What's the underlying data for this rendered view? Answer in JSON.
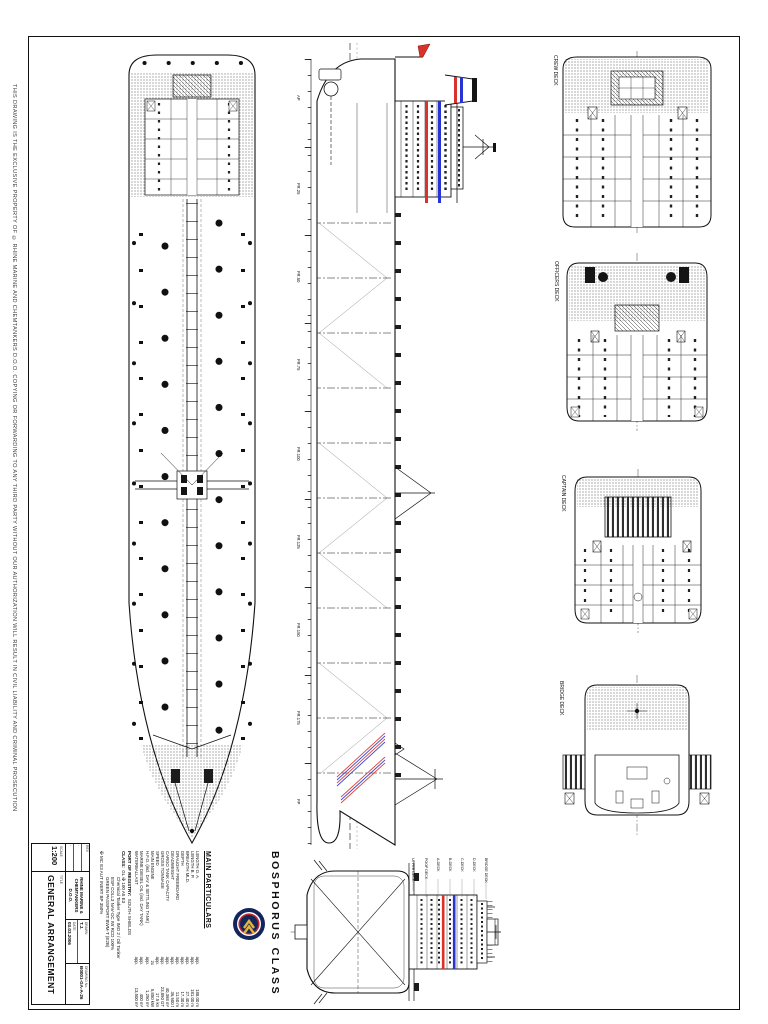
{
  "sheet": {
    "margin_notice": "THIS DRAWING IS THE EXCLUSIVE PROPERTY OF © RHINE MARINE AND CHEMTANKERS D.O.O.  COPYING OR FORWARDING TO ANY THIRD PARTY WITHOUT OUR AUTHORIZATION WILL RESULT IN CIVIL LIABILITY AND CRIMINAL PROSECUTION",
    "watermark": "CHEMTANKER.ORG"
  },
  "vessel": {
    "class_name": "BOSPHORUS CLASS",
    "particulars_heading": "MAIN PARTICULARS",
    "particulars": [
      {
        "label": "LENGTH O. A.",
        "approx": "app.",
        "value": "188.00 m"
      },
      {
        "label": "LENGTH B. P.",
        "approx": "app.",
        "value": "181.00 m"
      },
      {
        "label": "BREADTH MLD.",
        "approx": "app.",
        "value": "27.40 m"
      },
      {
        "label": "DEPTH",
        "approx": "app.",
        "value": "17.30 m"
      },
      {
        "label": "DRAUGHT FREEBOARD",
        "approx": "app.",
        "value": "11.50 m"
      },
      {
        "label": "DEADWEIGHT",
        "approx": "app.",
        "value": "36,500 t"
      },
      {
        "label": "CARGO TANK CAPACITY",
        "approx": "app.",
        "value": "40,368 m³"
      },
      {
        "label": "GROSS TONNAGE",
        "approx": "app.",
        "value": "23,850 GT"
      },
      {
        "label": "SPEED",
        "approx": "app.",
        "value": "17.5 kn"
      },
      {
        "label": "MAIN ENGINE",
        "approx": "2x",
        "value": "5,850 kW"
      },
      {
        "label": "H.F.O. (incl. DAY & SETTLING TANK)",
        "approx": "app.",
        "value": "1,250 m³"
      },
      {
        "label": "MARINE DIESEL OIL (incl. DAY TANK)",
        "approx": "app.",
        "value": "400 m³"
      },
      {
        "label": "WATERBALLAST",
        "approx": "app.",
        "value": "13,500 m³"
      }
    ],
    "registry_label": "PORT OF REGISTRY:",
    "registry_value": "SOUTH SHIELDS",
    "class_label": "CLASS:",
    "class_value": "GL ✠ 100 A5 E3",
    "class_notations": [
      "Chemical Tanker Type IMO 2 / Oil Tanker",
      "ESP COLL3 NAV-OC IW RCD 100%",
      "GREEN PASSPORT BWM-T (E2B)",
      "✠ MC E3 AUT INERT BP 350%"
    ]
  },
  "views": {
    "deck_plans": [
      {
        "label": "CREW DECK"
      },
      {
        "label": "OFFICERS DECK"
      },
      {
        "label": "CAPTAIN DECK"
      },
      {
        "label": "BRIDGE DECK"
      }
    ],
    "aft_deck_labels": [
      "BRIDGE DECK",
      "D-DECK",
      "C-DECK",
      "B-DECK",
      "A-DECK",
      "POOP DECK",
      "UPPER DECK"
    ],
    "frame_marks": [
      "AP",
      "FR.25",
      "FR.50",
      "FR.75",
      "FR.100",
      "FR.125",
      "FR.150",
      "FR.175",
      "FP"
    ]
  },
  "title_block": {
    "scale_label": "SCALE",
    "scale": "1:200",
    "title_label": "TITLE",
    "title": "GENERAL ARRANGEMENT",
    "company_line1": "RHINE MARINE &",
    "company_line2": "CHEMTANKERS D.O.O.",
    "drawn_label": "DRAWN",
    "drawn_value": "T.J.",
    "date_label": "DATE",
    "date_value": "03.03.2006",
    "drawing_no_label": "DRAWING No.",
    "drawing_no": "B0001-GA-A-26",
    "rev_rows": [
      "REV",
      "-",
      "-"
    ]
  },
  "colors": {
    "accent_red": "#d9322a",
    "accent_blue": "#2733d2",
    "line": "#151515",
    "watermark": "#cccccc"
  }
}
